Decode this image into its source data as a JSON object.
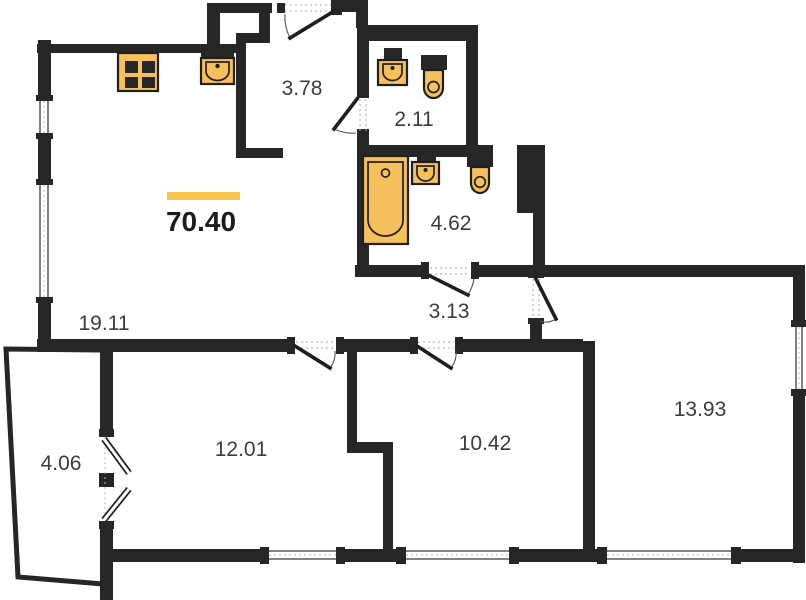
{
  "floor_plan": {
    "total_area": "70.40",
    "rooms": [
      {
        "name": "living-kitchen",
        "area": "19.11"
      },
      {
        "name": "hallway",
        "area": "3.78"
      },
      {
        "name": "wc",
        "area": "2.11"
      },
      {
        "name": "bathroom",
        "area": "4.62"
      },
      {
        "name": "corridor",
        "area": "3.13"
      },
      {
        "name": "room-left",
        "area": "12.01"
      },
      {
        "name": "room-middle",
        "area": "10.42"
      },
      {
        "name": "room-right",
        "area": "13.93"
      },
      {
        "name": "balcony",
        "area": "4.06"
      }
    ],
    "fixtures": [
      "stove-icon",
      "kitchen-sink-icon",
      "washbasin-icon",
      "toilet-icon",
      "bathtub-icon"
    ],
    "colors": {
      "wall": "#262626",
      "fixture_fill": "#f6c05c",
      "accent_bar": "#f9c74b",
      "label_text": "#3c3c3c",
      "total_text": "#1c1c1c",
      "background": "#ffffff"
    }
  }
}
